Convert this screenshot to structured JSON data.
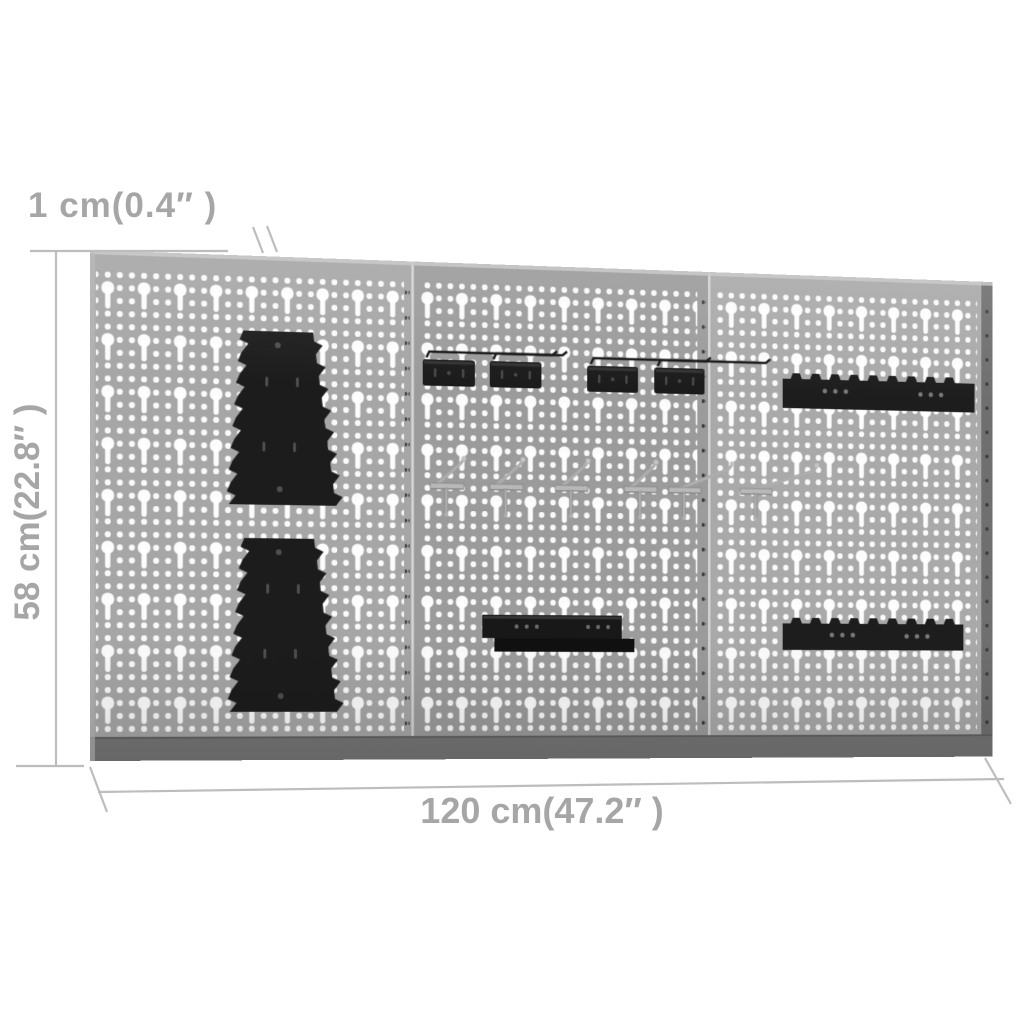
{
  "annotations": {
    "thickness_label": "1 cm(0.4″ )",
    "height_label": "58 cm(22.8″ )",
    "width_label": "120 cm(47.2″ )",
    "text_color": "#a6a6a6",
    "line_color": "#bdbdbd"
  },
  "board": {
    "panel_count": 3,
    "colors": {
      "panel_1": "#a6a6a6",
      "panel_2": "#9b9b9b",
      "panel_3": "#a9a9a9",
      "hole": "#ffffff",
      "top_fold": "#c6c6c6",
      "bottom_fold": "#757575",
      "right_edge": "#6f6f6f",
      "seam_gap": "#d8d8d8",
      "mount_hole": "#3a3a3a",
      "accessory_black": "#1c1c1c",
      "accessory_detail": "#4f4f4f",
      "hook_silver": "#adadad"
    },
    "accessories": {
      "wrench_holder_count": 2,
      "hook_plate_count": 4,
      "single_hook_count": 6,
      "sawtooth_rail_count": 2,
      "shelf_count": 1
    }
  }
}
